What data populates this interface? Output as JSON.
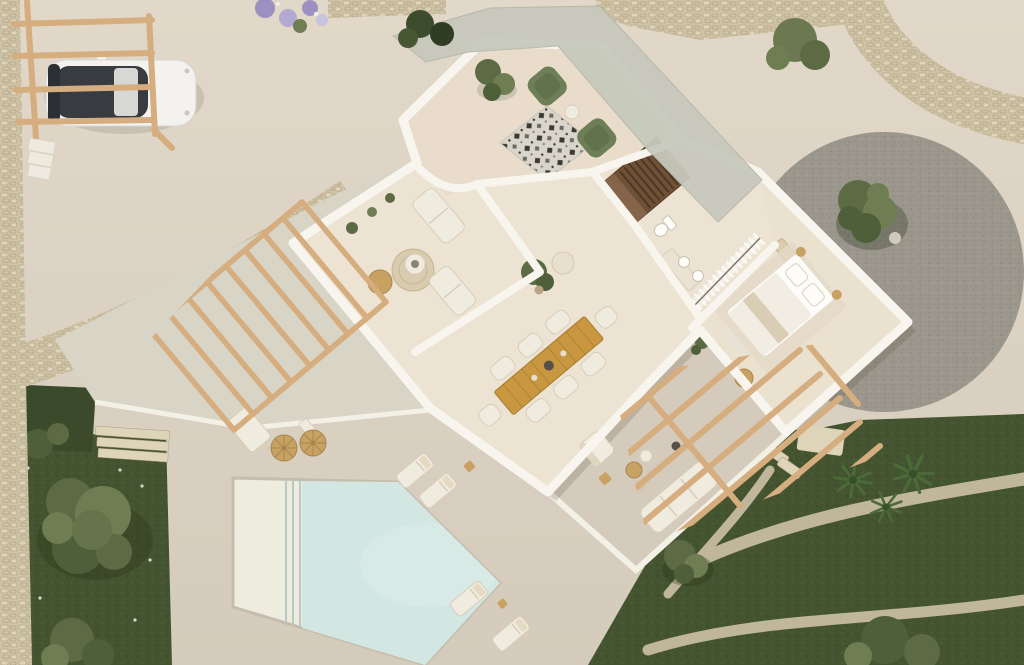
{
  "scene": {
    "type": "3d-aerial-floorplan-render",
    "subject": "villa top view with pool, garden, carport and furnished rooms"
  },
  "regions": [
    "carport",
    "driveway",
    "entry-canopy",
    "sitting-terrace",
    "living-room",
    "dining-room",
    "hallway",
    "staircase",
    "bathroom",
    "walk-in-closet",
    "bedroom",
    "pergola-terrace",
    "pool-deck",
    "swimming-pool",
    "gravel-garden",
    "lawn-south",
    "lawn-west",
    "stone-walls",
    "garden-paths"
  ],
  "counts": {
    "green_armchairs": 2,
    "dining_chairs": 8,
    "sun_loungers": 4,
    "straw_parasols": 2,
    "palm_trees": 3,
    "indoor_sofa_modules": 2,
    "beds": 1,
    "cars": 1
  },
  "colors": {
    "bg_top": "#e2d8c9",
    "bg_bottom": "#d5cbbc",
    "deck": "#d8d4c6",
    "deck_edge": "#f3f0e6",
    "house_floor": "#ece3d2",
    "terrace_floor": "#e9dccb",
    "bedroom_floor": "#ebe1cf",
    "wall": "#f8f5ee",
    "canopy": "#c7c9bc",
    "pool_water": "#d2e7e2",
    "pool_shallow": "#edecdf",
    "pool_step": "#b9c9c3",
    "pool_coping": "#c6bcab",
    "lawn": "#445430",
    "lawn_light": "#4e5f36",
    "hedge": "#3a4a2b",
    "gravel": "#9b978d",
    "gravel_dark": "#8b877d",
    "stone": "#cfc3a6",
    "stone_dark": "#ab9c7b",
    "stone_light": "#ddd4ba",
    "wood": "#d5ad7e",
    "table_wood": "#c8973f",
    "table_wood_edge": "#a87b33",
    "stair_dark": "#6f5138",
    "stair_light": "#85644a",
    "tread": "#4e3823",
    "chair_green": "#6e7f58",
    "chair_green_dark": "#5a6b47",
    "rug_base": "#d9d5cb",
    "rug_dark": "#3a3a33",
    "straw": "#c8a263",
    "straw_dark": "#a8854e",
    "white_furn": "#f0ebdf",
    "white_furn_line": "#d8cdb8",
    "car_body": "#f3f2ef",
    "car_glass": "#383c41",
    "car_rear_glass": "#2c2f34",
    "olive_dark": "#4e5f3a",
    "olive_mid": "#5d6b44",
    "olive_light": "#6e7d52",
    "palm": "#4c6a38",
    "palm_dark": "#35502a",
    "jute": "#d9cbae",
    "jute_line": "#c3b392",
    "lavender": "#9b90bf",
    "lavender_light": "#b3a9d1",
    "white": "#fdfcf8",
    "dark_item": "#55504a",
    "path_stone": "#cabfa6",
    "shadow": "rgba(92,80,60,0.20)",
    "tree_shadow": "rgba(40,50,28,0.30)"
  }
}
